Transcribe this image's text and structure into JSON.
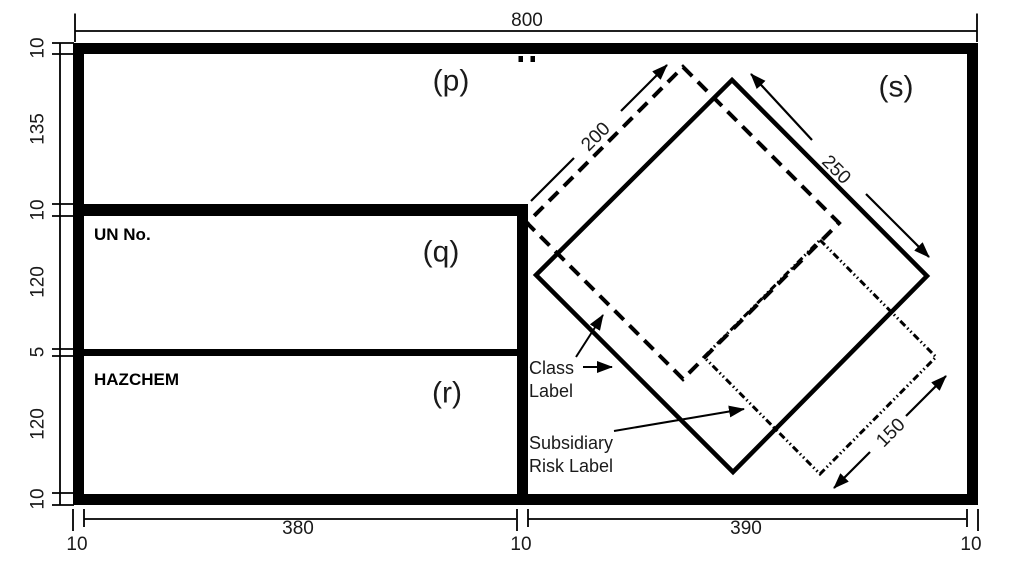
{
  "diagram": {
    "type": "dimensioned-technical-drawing",
    "panel_labels": {
      "p": "(p)",
      "q": "(q)",
      "r": "(r)",
      "s": "(s)"
    },
    "field_labels": {
      "un_no": "UN No.",
      "hazchem": "HAZCHEM"
    },
    "annotations": {
      "class_line1": "Class",
      "class_line2": "Label",
      "subsidiary_line1": "Subsidiary",
      "subsidiary_line2": "Risk Label"
    },
    "dimensions": {
      "top": "800",
      "left": [
        "10",
        "135",
        "10",
        "120",
        "5",
        "120",
        "10"
      ],
      "bottom": [
        "10",
        "380",
        "10",
        "390",
        "10"
      ]
    },
    "diamond_dimensions": {
      "dashed": "200",
      "solid": "250",
      "dotted": "150"
    },
    "colors": {
      "line": "#000000",
      "text": "#1a1a1a",
      "background": "#ffffff"
    }
  }
}
